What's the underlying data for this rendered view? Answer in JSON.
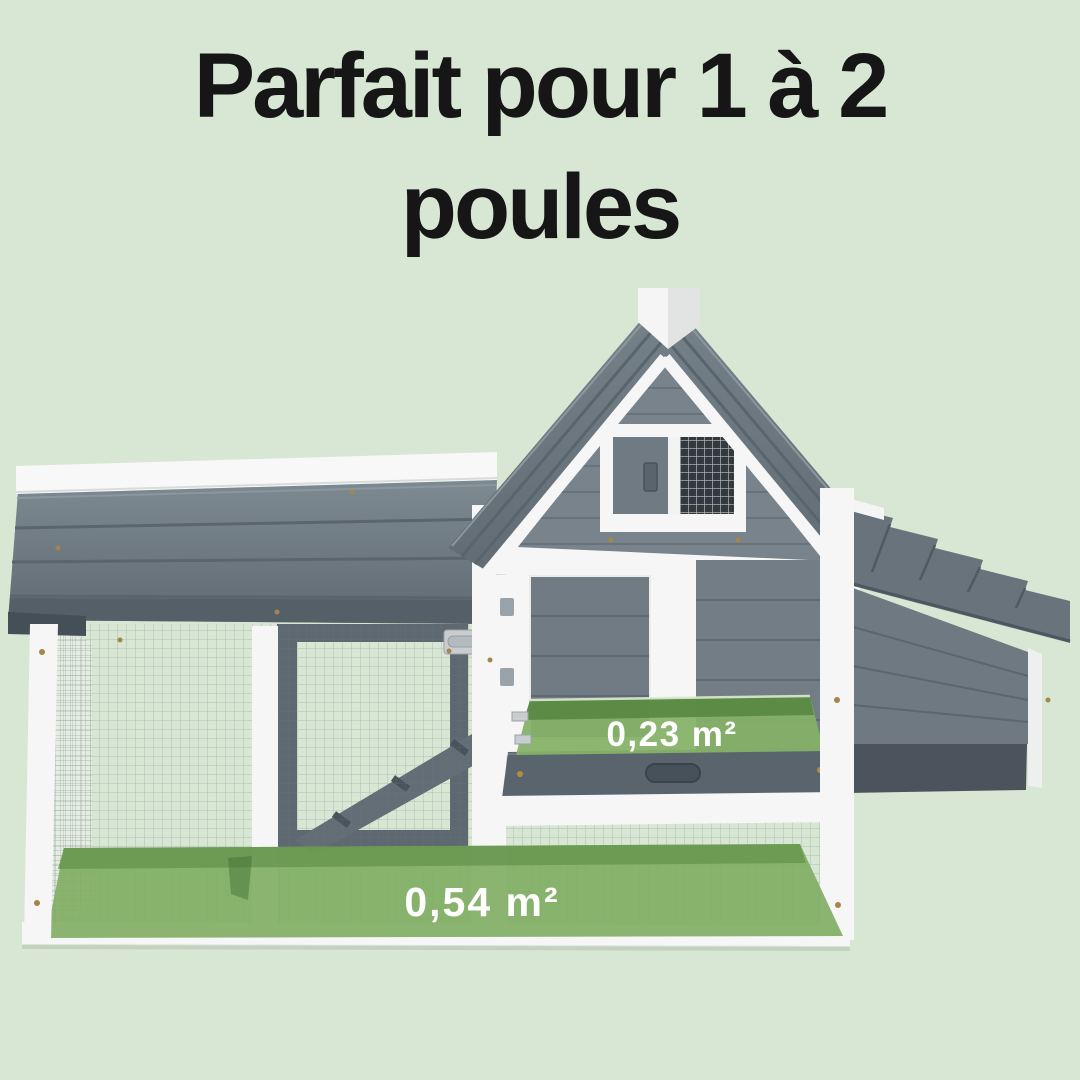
{
  "title": {
    "line1": "Parfait pour 1 à 2",
    "line2": "poules"
  },
  "overlays": {
    "house_floor": {
      "label": "0,23 m²"
    },
    "run_floor": {
      "label": "0,54 m²"
    }
  },
  "colors": {
    "background": "#d8e6d4",
    "highlight_green": "#7fad62",
    "highlight_green_dark": "#699750",
    "roof_gray": "#6b7680",
    "siding_gray": "#79838b",
    "frame_white": "#f5f6f5",
    "title_text": "#161616",
    "label_text": "#ffffff"
  }
}
